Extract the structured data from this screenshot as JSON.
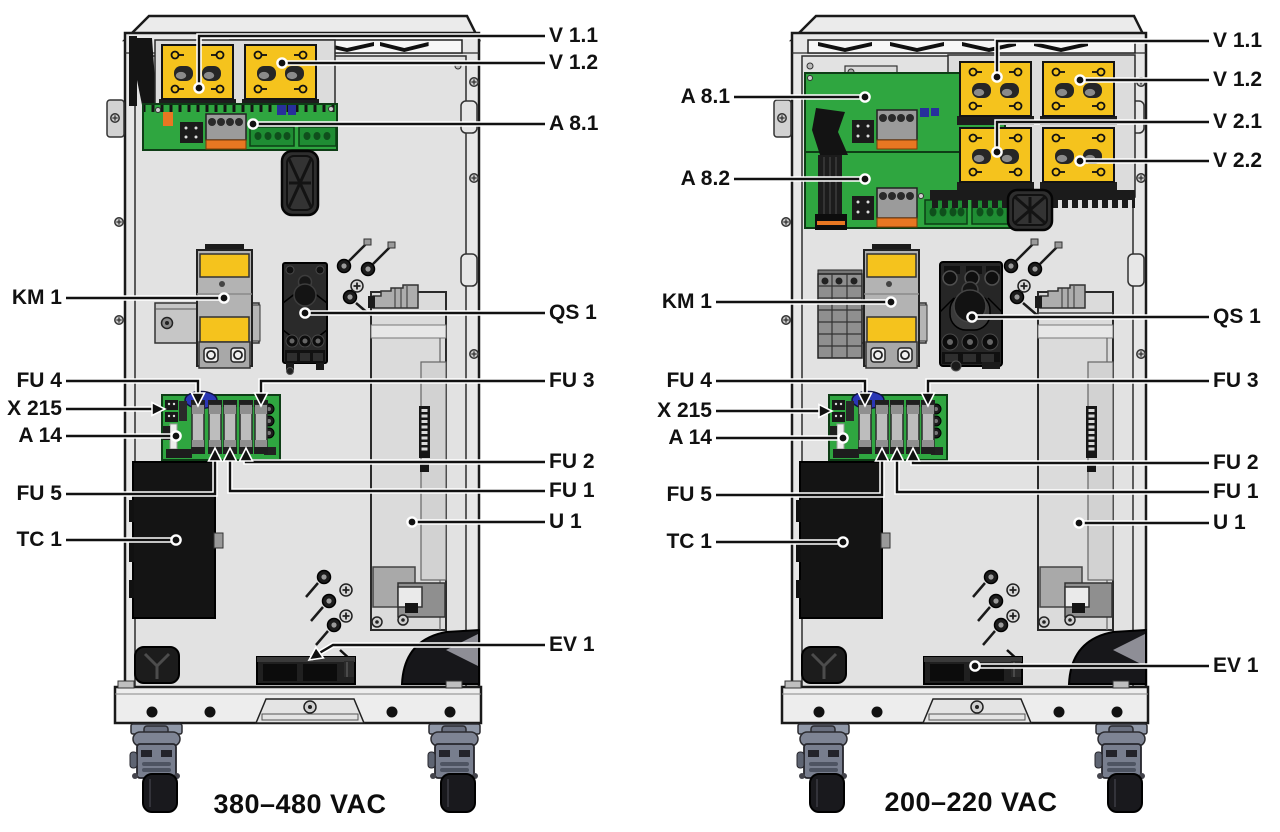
{
  "figure": {
    "description": "Component location diagram of two drive cabinets",
    "units": [
      {
        "caption": "380–480 VAC",
        "callouts": {
          "v11": "V 1.1",
          "v12": "V 1.2",
          "a81": "A 8.1",
          "qs1": "QS 1",
          "fu3": "FU 3",
          "fu2": "FU 2",
          "fu1": "FU 1",
          "u1": "U 1",
          "ev1": "EV 1",
          "km1": "KM 1",
          "fu4": "FU 4",
          "x215": "X 215",
          "a14": "A 14",
          "fu5": "FU 5",
          "tc1": "TC 1"
        }
      },
      {
        "caption": "200–220 VAC",
        "callouts": {
          "v11": "V 1.1",
          "v12": "V 1.2",
          "v21": "V 2.1",
          "v22": "V 2.2",
          "a81": "A 8.1",
          "a82": "A 8.2",
          "qs1": "QS 1",
          "fu3": "FU 3",
          "fu2": "FU 2",
          "fu1": "FU 1",
          "u1": "U 1",
          "ev1": "EV 1",
          "km1": "KM 1",
          "fu4": "FU 4",
          "x215": "X 215",
          "a14": "A 14",
          "fu5": "FU 5",
          "tc1": "TC 1"
        }
      }
    ],
    "colors": {
      "module_yellow": "#F5C31D",
      "pcb_green": "#2FA640",
      "cabinet_gray": "#E7E7E7",
      "line_black": "#111111"
    }
  }
}
